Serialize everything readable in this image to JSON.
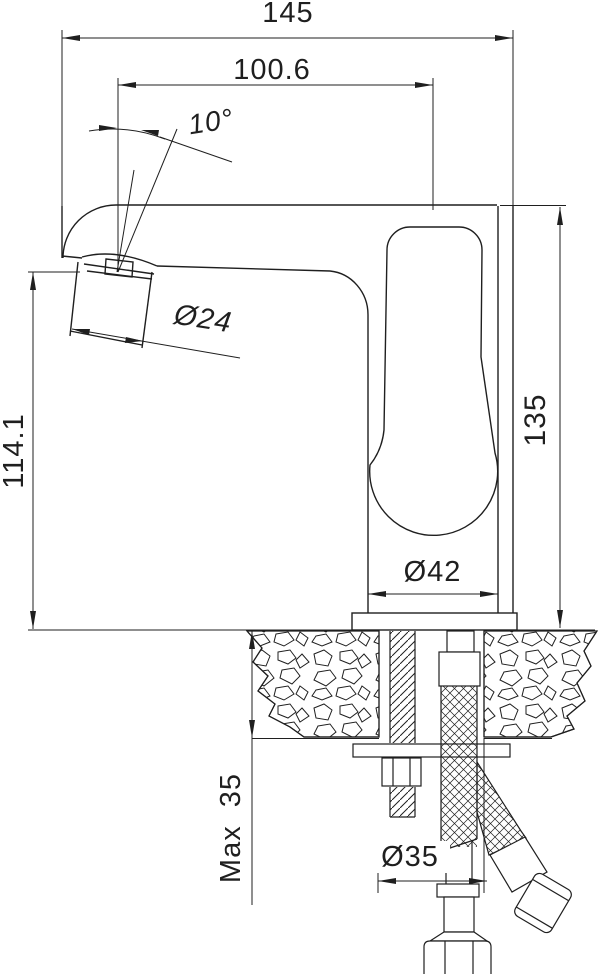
{
  "dims": {
    "overall_length": "145",
    "spout_projection": "100.6",
    "spout_angle": "10°",
    "aerator_diameter": "Ø24",
    "spout_height": "114.1",
    "body_height": "135",
    "base_diameter": "Ø42",
    "max_deck_thickness": "Max  35",
    "hole_diameter": "Ø35"
  }
}
